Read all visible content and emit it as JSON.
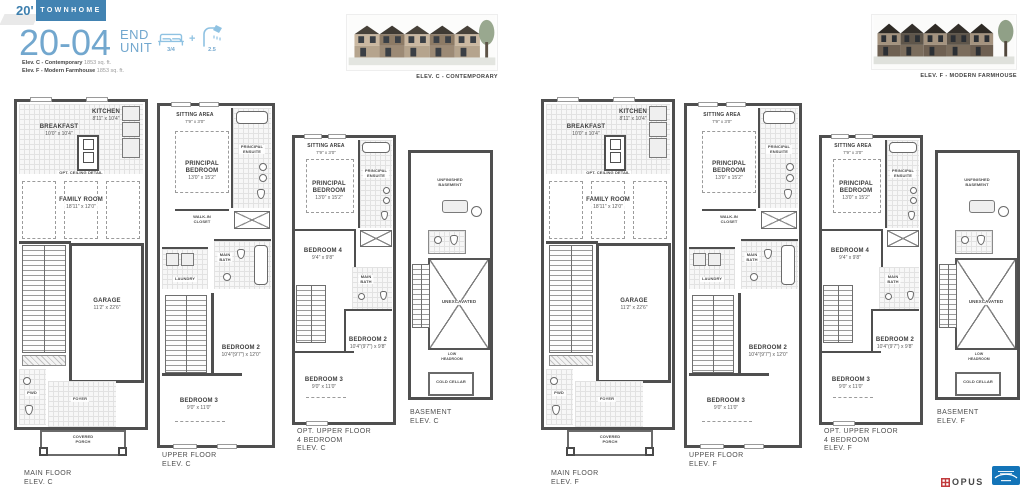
{
  "header": {
    "lot_width": "20'",
    "product_type": "TOWNHOME",
    "plan_number": "20-04",
    "unit_line1": "END",
    "unit_line2": "UNIT",
    "beds": "3/4",
    "plus": "+",
    "baths": "2.5",
    "elev_lines": [
      {
        "name": "Elev. C - Contemporary",
        "area": "1853 sq. ft."
      },
      {
        "name": "Elev. F - Modern Farmhouse",
        "area": "1853 sq. ft."
      }
    ]
  },
  "renders": [
    {
      "caption": "ELEV. C - CONTEMPORARY"
    },
    {
      "caption": "ELEV. F - MODERN FARMHOUSE"
    }
  ],
  "rooms": {
    "kitchen_name": "KITCHEN",
    "kitchen_dims": "8'11\" x 10'4\"",
    "breakfast_name": "BREAKFAST",
    "breakfast_dims": "10'0\" x 10'4\"",
    "ceiling_note": "OPT. CEILING DETAIL",
    "family_name": "FAMILY ROOM",
    "family_dims": "18'11\" x 12'0\"",
    "garage_name": "GARAGE",
    "garage_dims": "11'2\" x 22'6\"",
    "pwd": "PWD",
    "foyer": "FOYER",
    "porch_line1": "COVERED",
    "porch_line2": "PORCH",
    "sitting_name": "SITTING AREA",
    "sitting_dims": "7'9\" x 3'0\"",
    "principal_line1": "PRINCIPAL",
    "principal_line2": "BEDROOM",
    "principal_dims": "13'0\" x 15'2\"",
    "ensuite_line1": "PRINCIPAL",
    "ensuite_line2": "ENSUITE",
    "wic_line1": "WALK-IN",
    "wic_line2": "CLOSET",
    "main_bath_line1": "MAIN",
    "main_bath_line2": "BATH",
    "laundry": "LAUNDRY",
    "bed2_name": "BEDROOM 2",
    "bed2_dims": "10'4\"(9'7\") x 12'0\"",
    "bed2_opt_dims": "10'4\"(9'7\") x 9'8\"",
    "bed3_name": "BEDROOM 3",
    "bed3_dims": "9'0\" x 11'0\"",
    "bed4_name": "BEDROOM 4",
    "bed4_dims": "9'4\" x 9'8\"",
    "unfinished_line1": "UNFINISHED",
    "unfinished_line2": "BASEMENT",
    "unexcavated": "UNEXCAVATED",
    "low_head_line1": "LOW",
    "low_head_line2": "HEADROOM",
    "cold_cellar": "COLD CELLAR"
  },
  "plan_labels": {
    "main": "MAIN FLOOR",
    "upper": "UPPER FLOOR",
    "opt_upper_line1": "OPT. UPPER FLOOR",
    "opt_upper_line2": "4 BEDROOM",
    "basement": "BASEMENT"
  },
  "groups": [
    {
      "x": 14,
      "elev": "ELEV. C"
    },
    {
      "x": 541,
      "elev": "ELEV. F"
    }
  ],
  "footer": {
    "brand": "OPUS"
  },
  "colors": {
    "accent_blue": "#4283b2",
    "title_blue": "#72a7ce",
    "icon_blue": "#8fc2e2",
    "wall_gray": "#4f4f4f",
    "text_gray": "#4f4f4f",
    "logo_red": "#c13a3c",
    "energy_blue": "#1374b8"
  }
}
